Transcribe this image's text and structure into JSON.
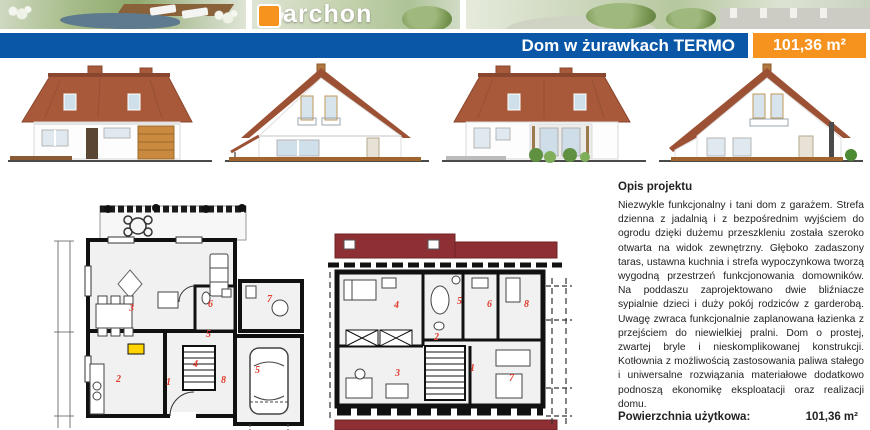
{
  "logo": {
    "text": "archon"
  },
  "header": {
    "title": "Dom w żurawkach TERMO",
    "area": "101,36 m²",
    "bar_color": "#0a57a8",
    "badge_color": "#f6921e"
  },
  "description": {
    "heading": "Opis projektu",
    "body": "Niezwykle funkcjonalny i tani dom z garażem. Strefa dzienna z jadalnią i z bezpośrednim wyjściem do ogrodu dzięki dużemu przeszkleniu została szeroko otwarta na widok zewnętrzny. Głęboko zadaszony taras, ustawna kuchnia i strefa wypoczynkowa tworzą wygodną przestrzeń funkcjonowania domowników. Na poddaszu zaprojektowano dwie bliźniacze sypialnie dzieci i duży pokój rodziców z garderobą. Uwagę zwraca funkcjonalnie zaplanowana łazienka z przejściem do niewielkiej pralni. Dom o prostej, zwartej bryle i nieskomplikowanej konstrukcji. Kotłownia z możliwością zastosowania paliwa stałego i uniwersalne rozwiązania materiałowe dodatkowo podnoszą ekonomikę eksploatacji oraz realizacji domu."
  },
  "summary": {
    "label": "Powierzchnia użytkowa:",
    "value": "101,36 m²"
  },
  "plans": {
    "ground": {
      "room_numbers": [
        "3",
        "2",
        "1",
        "4",
        "8",
        "6",
        "5",
        "7",
        "5"
      ]
    },
    "attic": {
      "room_numbers": [
        "4",
        "5",
        "6",
        "8",
        "2",
        "3",
        "1",
        "7"
      ]
    }
  },
  "colors": {
    "roof": "#a8593a",
    "attic_roof_band": "#8e3033",
    "room_number_red": "#e23b2e"
  }
}
